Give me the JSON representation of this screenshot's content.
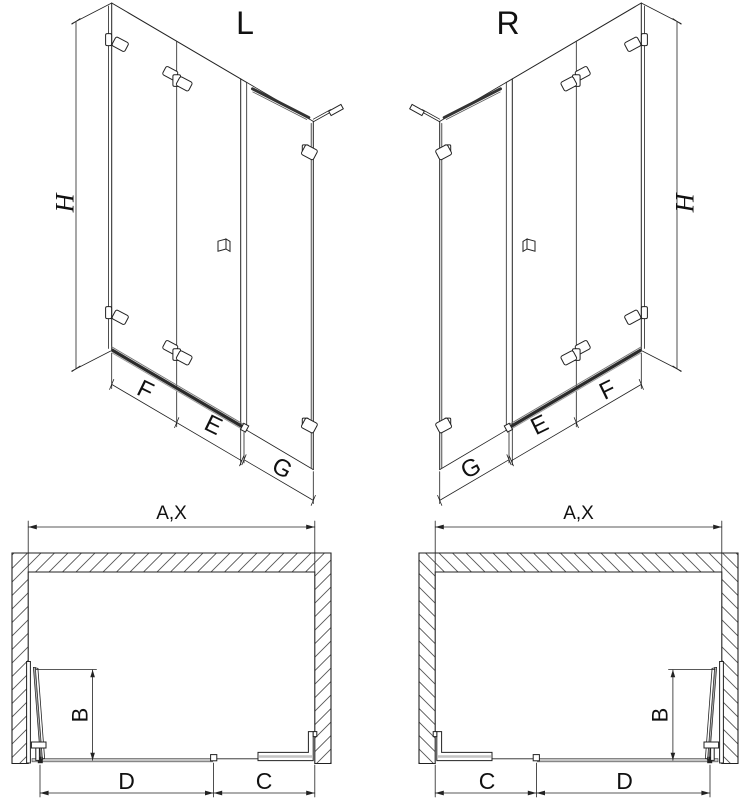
{
  "drawing": {
    "iso_left": {
      "title": "L",
      "dim_height": "H",
      "dim_front": "F",
      "dim_door": "E",
      "dim_side": "G"
    },
    "iso_right": {
      "title": "R",
      "dim_height": "H",
      "dim_front": "F",
      "dim_door": "E",
      "dim_side": "G"
    },
    "plan_left": {
      "dim_width": "A,X",
      "dim_depth": "B",
      "dim_door_span": "D",
      "dim_side_span": "C"
    },
    "plan_right": {
      "dim_width": "A,X",
      "dim_depth": "B",
      "dim_door_span": "D",
      "dim_side_span": "C"
    }
  },
  "colors": {
    "line": "#222222",
    "rail_dark": "#2b2b2b",
    "rail_light": "#c4c4c4",
    "background": "#ffffff"
  }
}
